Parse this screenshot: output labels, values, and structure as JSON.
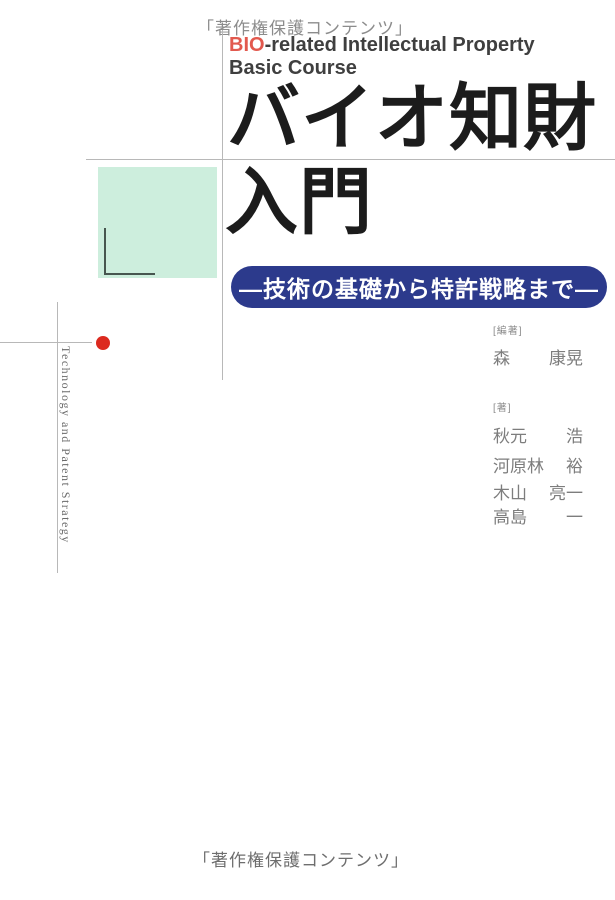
{
  "cover": {
    "watermark_top": "「著作権保護コンテンツ」",
    "watermark_bottom": "「著作権保護コンテンツ」",
    "course": {
      "highlight": "BIO",
      "line1_rest": "-related Intellectual Property",
      "line2": "Basic Course"
    },
    "title": {
      "line1": "バイオ知財",
      "line2": "入門"
    },
    "subtitle": "―技術の基礎から特許戦略まで―",
    "side_text": "Technology and Patent Strategy",
    "editor": {
      "label": "[編著]",
      "name": [
        "森",
        "康晃"
      ]
    },
    "authors": {
      "label": "[著]",
      "names": [
        [
          "秋元",
          "浩"
        ],
        [
          "河原林",
          "裕"
        ],
        [
          "木山",
          "亮一"
        ],
        [
          "高島",
          "一"
        ]
      ]
    },
    "colors": {
      "accent_red": "#e2594e",
      "navy": "#2c3a8c",
      "mint": "#cdeedd",
      "dot_red": "#dc2a1f"
    }
  }
}
